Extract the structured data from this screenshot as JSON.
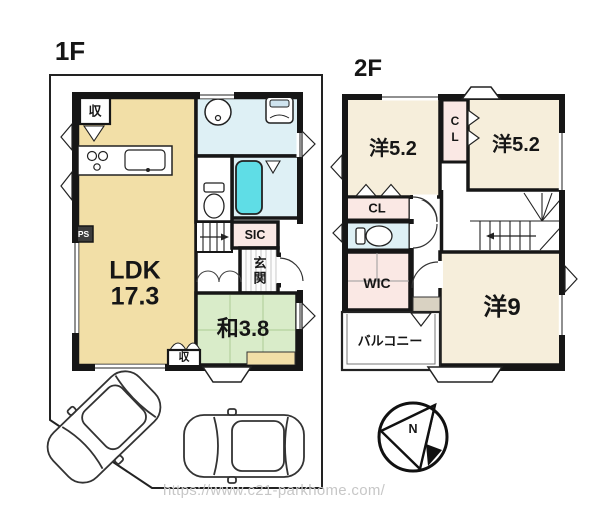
{
  "floor1": {
    "title": "1F",
    "rooms": {
      "ldk_name": "LDK",
      "ldk_size": "17.3",
      "washitsu": "和3.8",
      "sic": "SIC",
      "genkan": "玄関",
      "storage_top": "収",
      "storage_bottom": "収",
      "ps": "PS"
    }
  },
  "floor2": {
    "title": "2F",
    "rooms": {
      "bedroom_left": "洋5.2",
      "bedroom_right": "洋5.2",
      "bedroom_main": "洋9",
      "closet_mid": "CL",
      "closet_left": "CL",
      "wic": "WIC",
      "balcony": "バルコニー"
    }
  },
  "compass": {
    "north": "N"
  },
  "watermark": {
    "url": "https://www.c21-parkhome.com/"
  },
  "colors": {
    "ldk_cream": "#f2dfa7",
    "bedroom_cream": "#f6eedb",
    "tatami_green": "#d9ecc9",
    "wet_blue": "#def0f5",
    "tub_cyan": "#5fdde6",
    "closet_pink": "#fae8e4",
    "counter_beige": "#d9d2c2",
    "wall": "#161616",
    "watermark_gray": "#c7c7c7"
  }
}
